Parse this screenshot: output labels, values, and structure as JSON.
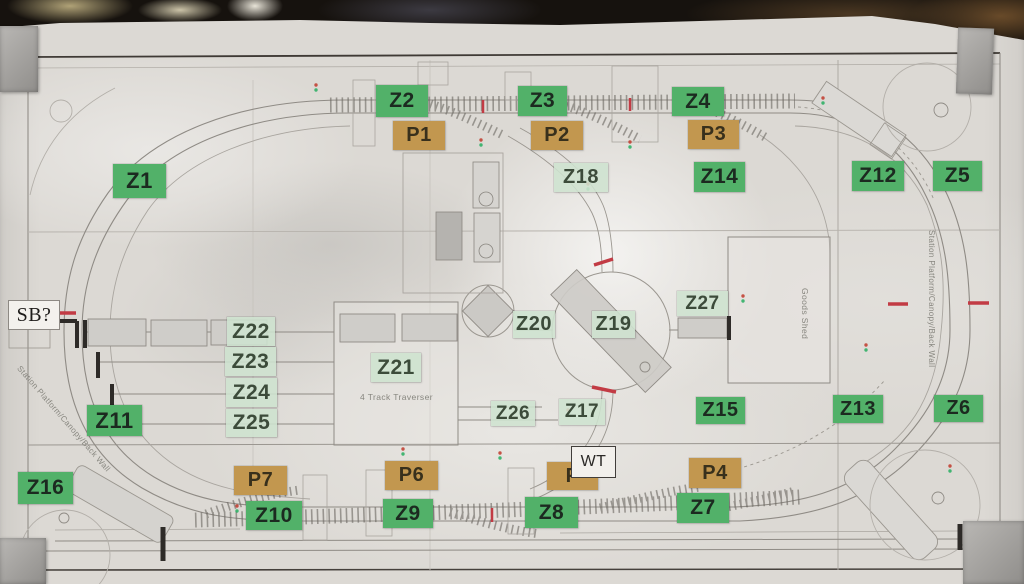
{
  "colors": {
    "label_green": "#52b169",
    "label_pale": "#cee3cf",
    "label_tan": "#c2974f",
    "paper": "#dcd9d4",
    "mark_red": "#c23b44"
  },
  "labels": [
    {
      "name": "label-z1",
      "text": "Z1",
      "type": "green",
      "x": 113,
      "y": 164,
      "w": 53,
      "h": 34,
      "fs": 22
    },
    {
      "name": "label-z2",
      "text": "Z2",
      "type": "green",
      "x": 376,
      "y": 85,
      "w": 52,
      "h": 32,
      "fs": 21
    },
    {
      "name": "label-z3",
      "text": "Z3",
      "type": "green",
      "x": 518,
      "y": 86,
      "w": 49,
      "h": 30,
      "fs": 21
    },
    {
      "name": "label-z4",
      "text": "Z4",
      "type": "green",
      "x": 672,
      "y": 87,
      "w": 52,
      "h": 29,
      "fs": 21
    },
    {
      "name": "label-z5",
      "text": "Z5",
      "type": "green",
      "x": 933,
      "y": 161,
      "w": 49,
      "h": 30,
      "fs": 21
    },
    {
      "name": "label-z6",
      "text": "Z6",
      "type": "green",
      "x": 934,
      "y": 395,
      "w": 49,
      "h": 27,
      "fs": 20
    },
    {
      "name": "label-z7",
      "text": "Z7",
      "type": "green",
      "x": 677,
      "y": 493,
      "w": 52,
      "h": 30,
      "fs": 21
    },
    {
      "name": "label-z8",
      "text": "Z8",
      "type": "green",
      "x": 525,
      "y": 497,
      "w": 53,
      "h": 31,
      "fs": 21
    },
    {
      "name": "label-z9",
      "text": "Z9",
      "type": "green",
      "x": 383,
      "y": 499,
      "w": 50,
      "h": 29,
      "fs": 21
    },
    {
      "name": "label-z10",
      "text": "Z10",
      "type": "green",
      "x": 246,
      "y": 501,
      "w": 56,
      "h": 29,
      "fs": 21
    },
    {
      "name": "label-z11",
      "text": "Z11",
      "type": "green",
      "x": 87,
      "y": 405,
      "w": 55,
      "h": 31,
      "fs": 22
    },
    {
      "name": "label-z12",
      "text": "Z12",
      "type": "green",
      "x": 852,
      "y": 161,
      "w": 52,
      "h": 30,
      "fs": 21
    },
    {
      "name": "label-z13",
      "text": "Z13",
      "type": "green",
      "x": 833,
      "y": 395,
      "w": 50,
      "h": 28,
      "fs": 20
    },
    {
      "name": "label-z14",
      "text": "Z14",
      "type": "green",
      "x": 694,
      "y": 162,
      "w": 51,
      "h": 30,
      "fs": 21
    },
    {
      "name": "label-z15",
      "text": "Z15",
      "type": "green",
      "x": 696,
      "y": 397,
      "w": 49,
      "h": 27,
      "fs": 20
    },
    {
      "name": "label-z16",
      "text": "Z16",
      "type": "green",
      "x": 18,
      "y": 472,
      "w": 55,
      "h": 32,
      "fs": 21
    },
    {
      "name": "label-z17",
      "text": "Z17",
      "type": "pale",
      "x": 559,
      "y": 399,
      "w": 46,
      "h": 26,
      "fs": 19
    },
    {
      "name": "label-z18",
      "text": "Z18",
      "type": "pale",
      "x": 554,
      "y": 163,
      "w": 54,
      "h": 29,
      "fs": 20
    },
    {
      "name": "label-z19",
      "text": "Z19",
      "type": "pale",
      "x": 592,
      "y": 311,
      "w": 43,
      "h": 27,
      "fs": 20
    },
    {
      "name": "label-z20",
      "text": "Z20",
      "type": "pale",
      "x": 513,
      "y": 311,
      "w": 42,
      "h": 27,
      "fs": 20
    },
    {
      "name": "label-z21",
      "text": "Z21",
      "type": "pale",
      "x": 371,
      "y": 353,
      "w": 50,
      "h": 29,
      "fs": 21
    },
    {
      "name": "label-z22",
      "text": "Z22",
      "type": "pale",
      "x": 227,
      "y": 317,
      "w": 48,
      "h": 29,
      "fs": 21
    },
    {
      "name": "label-z23",
      "text": "Z23",
      "type": "pale",
      "x": 225,
      "y": 347,
      "w": 51,
      "h": 29,
      "fs": 21
    },
    {
      "name": "label-z24",
      "text": "Z24",
      "type": "pale",
      "x": 226,
      "y": 378,
      "w": 51,
      "h": 29,
      "fs": 21
    },
    {
      "name": "label-z25",
      "text": "Z25",
      "type": "pale",
      "x": 226,
      "y": 409,
      "w": 51,
      "h": 28,
      "fs": 21
    },
    {
      "name": "label-z26",
      "text": "Z26",
      "type": "pale",
      "x": 491,
      "y": 401,
      "w": 44,
      "h": 25,
      "fs": 19
    },
    {
      "name": "label-z27",
      "text": "Z27",
      "type": "pale",
      "x": 677,
      "y": 291,
      "w": 51,
      "h": 25,
      "fs": 19
    },
    {
      "name": "label-p1",
      "text": "P1",
      "type": "tan",
      "x": 393,
      "y": 121,
      "w": 52,
      "h": 29,
      "fs": 20
    },
    {
      "name": "label-p2",
      "text": "P2",
      "type": "tan",
      "x": 531,
      "y": 121,
      "w": 52,
      "h": 29,
      "fs": 20
    },
    {
      "name": "label-p3",
      "text": "P3",
      "type": "tan",
      "x": 688,
      "y": 120,
      "w": 51,
      "h": 29,
      "fs": 20
    },
    {
      "name": "label-p4",
      "text": "P4",
      "type": "tan",
      "x": 689,
      "y": 458,
      "w": 52,
      "h": 30,
      "fs": 20
    },
    {
      "name": "label-p6",
      "text": "P6",
      "type": "tan",
      "x": 385,
      "y": 461,
      "w": 53,
      "h": 29,
      "fs": 20
    },
    {
      "name": "label-p7",
      "text": "P7",
      "type": "tan",
      "x": 234,
      "y": 466,
      "w": 53,
      "h": 29,
      "fs": 20
    },
    {
      "name": "label-p",
      "text": "P",
      "type": "tan",
      "x": 547,
      "y": 462,
      "w": 51,
      "h": 28,
      "fs": 20
    },
    {
      "name": "note-sb",
      "text": "SB?",
      "type": "serif-box",
      "x": 8,
      "y": 300,
      "w": 50,
      "h": 28,
      "fs": 20
    },
    {
      "name": "note-wt",
      "text": "WT",
      "type": "plain-box",
      "x": 571,
      "y": 446,
      "w": 43,
      "h": 30,
      "fs": 16
    }
  ],
  "plan_texts": [
    {
      "name": "traverser-caption",
      "text": "4 Track Traverser",
      "x": 360,
      "y": 392,
      "fs": 8.5,
      "rot": 0
    },
    {
      "name": "goods-shed-caption",
      "text": "Goods Shed",
      "x": 810,
      "y": 288,
      "fs": 8.5,
      "rot": 90
    },
    {
      "name": "back-wall-right-caption",
      "text": "Station Platform/Canopy/Back Wall",
      "x": 936,
      "y": 230,
      "fs": 8,
      "rot": 90
    },
    {
      "name": "back-wall-left-caption",
      "text": "Station Platform/Canopy/Back Wall",
      "x": 22,
      "y": 364,
      "fs": 8,
      "rot": 49
    }
  ]
}
